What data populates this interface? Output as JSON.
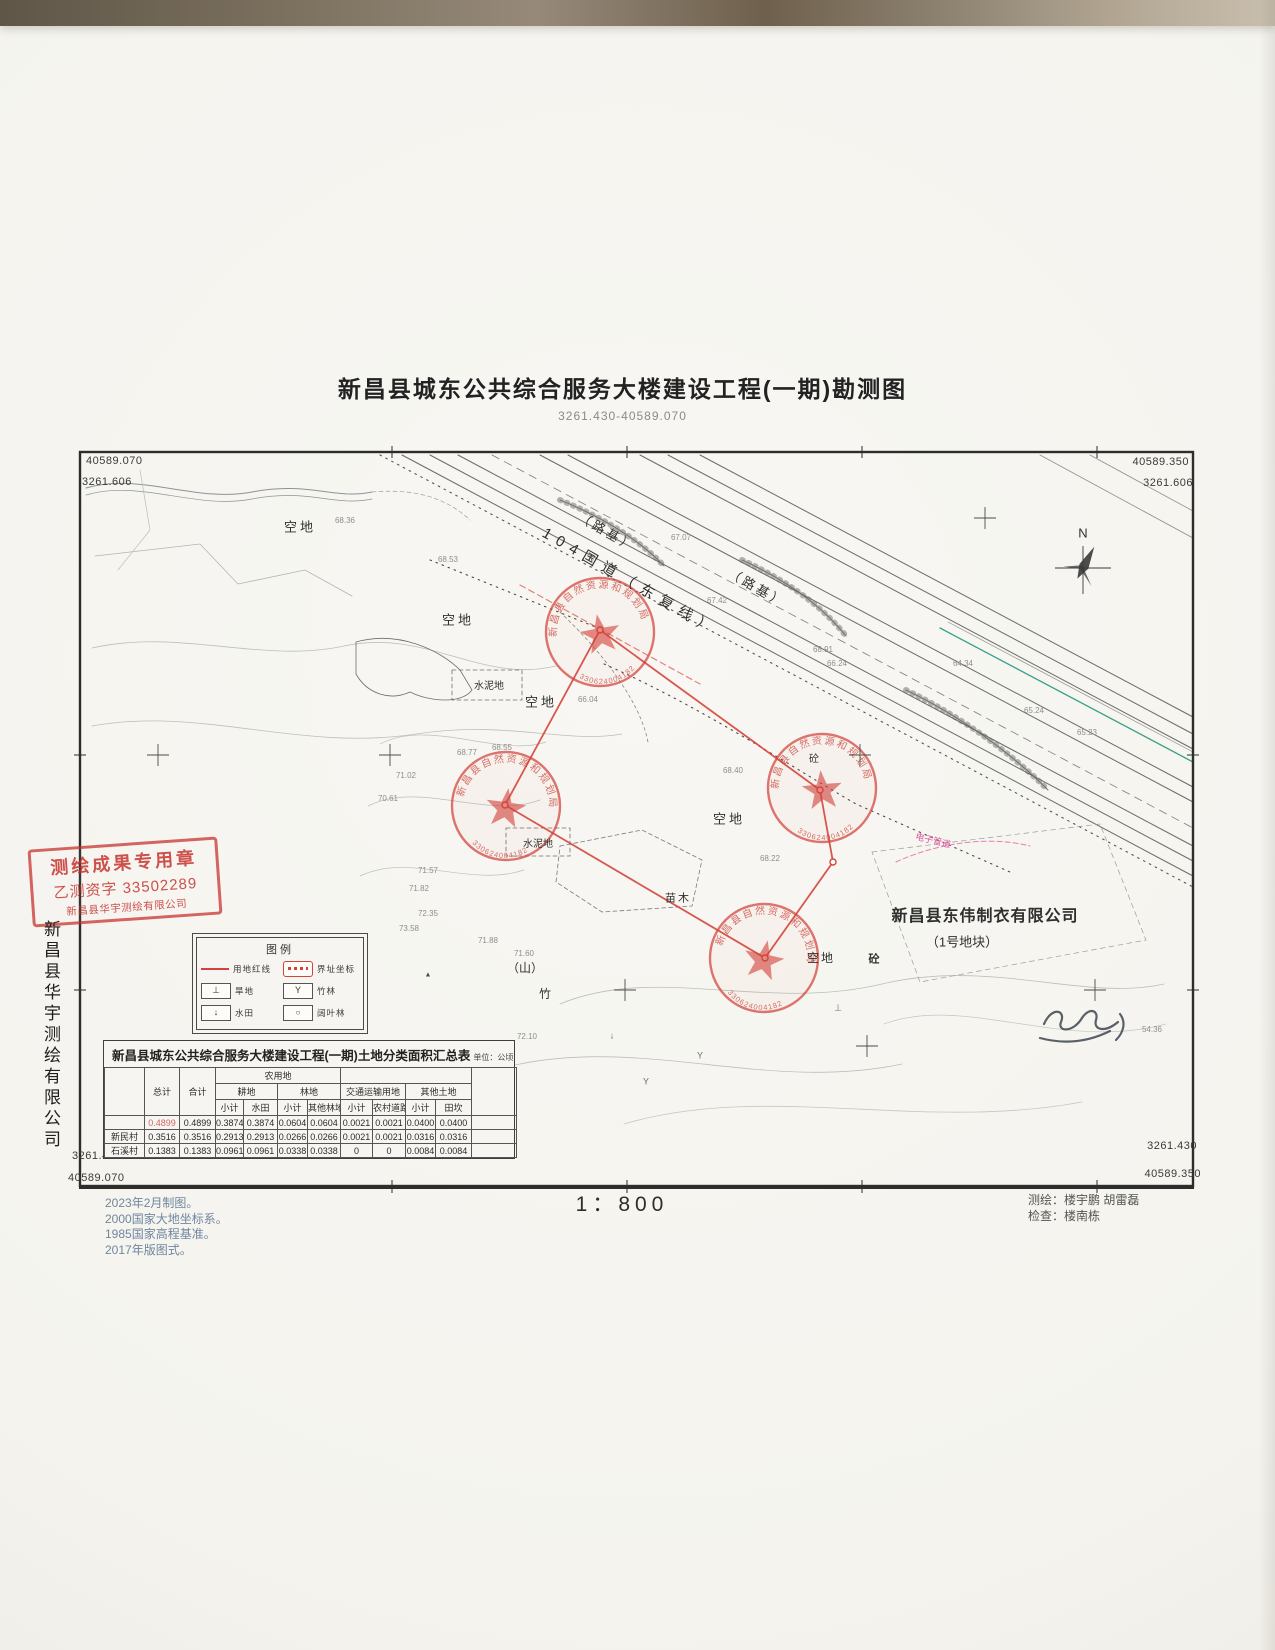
{
  "title": {
    "main": "新昌县城东公共综合服务大楼建设工程(一期)勘测图",
    "coords_range": "3261.430-40589.070"
  },
  "frame": {
    "top_left_x": "40589.070",
    "top_left_y": "3261.606",
    "top_right_x": "40589.350",
    "top_right_y": "3261.606",
    "bottom_left_y": "3261.430",
    "bottom_left_x": "40589.070",
    "bottom_right_y": "3261.430",
    "bottom_right_x": "40589.350"
  },
  "map": {
    "labels": [
      {
        "text": "104国道（东复线）",
        "x": 630,
        "y": 582,
        "size": 15,
        "rot": 30,
        "spacing": 7
      },
      {
        "text": "（路基）",
        "x": 607,
        "y": 532,
        "size": 13,
        "rot": 30,
        "spacing": 3
      },
      {
        "text": "（路基）",
        "x": 757,
        "y": 588,
        "size": 13,
        "rot": 30,
        "spacing": 3
      },
      {
        "text": "空地",
        "x": 300,
        "y": 527,
        "size": 13,
        "spacing": 3
      },
      {
        "text": "空地",
        "x": 458,
        "y": 620,
        "size": 13,
        "spacing": 3
      },
      {
        "text": "空地",
        "x": 541,
        "y": 702,
        "size": 13,
        "spacing": 3
      },
      {
        "text": "空地",
        "x": 729,
        "y": 819,
        "size": 13,
        "spacing": 3
      },
      {
        "text": "空地",
        "x": 821,
        "y": 958,
        "size": 12,
        "spacing": 2
      },
      {
        "text": "水泥地",
        "x": 489,
        "y": 687,
        "size": 10
      },
      {
        "text": "水泥地",
        "x": 538,
        "y": 845,
        "size": 10
      },
      {
        "text": "苗木",
        "x": 678,
        "y": 899,
        "size": 11,
        "spacing": 2
      },
      {
        "text": "（山）",
        "x": 525,
        "y": 968,
        "size": 12
      },
      {
        "text": "竹",
        "x": 545,
        "y": 994,
        "size": 12
      },
      {
        "text": "新昌县东伟制衣有限公司",
        "x": 985,
        "y": 917,
        "size": 16,
        "bold": true,
        "spacing": 1
      },
      {
        "text": "（1号地块）",
        "x": 962,
        "y": 942,
        "size": 13
      },
      {
        "text": "电子管道",
        "x": 933,
        "y": 841,
        "size": 9,
        "color": "#e0559e",
        "rot": 14
      },
      {
        "text": "N",
        "x": 1083,
        "y": 533,
        "size": 13
      },
      {
        "text": "砼",
        "x": 874,
        "y": 960,
        "size": 11,
        "bold": true
      },
      {
        "text": "砼",
        "x": 814,
        "y": 760,
        "size": 10
      },
      {
        "text": "Y",
        "x": 700,
        "y": 1056,
        "size": 9,
        "color": "#6b6b68"
      },
      {
        "text": "Y",
        "x": 646,
        "y": 1082,
        "size": 9,
        "color": "#6b6b68"
      },
      {
        "text": "↓",
        "x": 612,
        "y": 1036,
        "size": 9,
        "color": "#6b6b68"
      },
      {
        "text": "⊥",
        "x": 838,
        "y": 1008,
        "size": 9,
        "color": "#6b6b68"
      },
      {
        "text": "▲",
        "x": 428,
        "y": 975,
        "size": 7,
        "color": "#4a4a48"
      }
    ],
    "elevations": [
      {
        "v": "68.36",
        "x": 345,
        "y": 521
      },
      {
        "v": "68.53",
        "x": 448,
        "y": 560
      },
      {
        "v": "67.07",
        "x": 681,
        "y": 538
      },
      {
        "v": "67.42",
        "x": 717,
        "y": 601
      },
      {
        "v": "68.91",
        "x": 823,
        "y": 650
      },
      {
        "v": "66.24",
        "x": 837,
        "y": 664
      },
      {
        "v": "64.34",
        "x": 963,
        "y": 664
      },
      {
        "v": "65.24",
        "x": 1034,
        "y": 711
      },
      {
        "v": "65.23",
        "x": 1087,
        "y": 733
      },
      {
        "v": "68.77",
        "x": 467,
        "y": 753
      },
      {
        "v": "68.55",
        "x": 502,
        "y": 748
      },
      {
        "v": "66.04",
        "x": 588,
        "y": 700
      },
      {
        "v": "68.40",
        "x": 733,
        "y": 771
      },
      {
        "v": "68.22",
        "x": 770,
        "y": 859
      },
      {
        "v": "70.61",
        "x": 388,
        "y": 799
      },
      {
        "v": "71.02",
        "x": 406,
        "y": 776
      },
      {
        "v": "71.57",
        "x": 428,
        "y": 871
      },
      {
        "v": "71.82",
        "x": 419,
        "y": 889
      },
      {
        "v": "72.35",
        "x": 428,
        "y": 914
      },
      {
        "v": "73.58",
        "x": 409,
        "y": 929
      },
      {
        "v": "71.88",
        "x": 488,
        "y": 941
      },
      {
        "v": "71.60",
        "x": 524,
        "y": 954
      },
      {
        "v": "72.10",
        "x": 527,
        "y": 1037
      },
      {
        "v": "54.36",
        "x": 1152,
        "y": 1030
      }
    ],
    "round_stamps": {
      "arc_text": "新昌县自然资源和规划局",
      "number": "330624004182",
      "positions": [
        {
          "x": 600,
          "y": 632,
          "rot": -10
        },
        {
          "x": 506,
          "y": 806,
          "rot": 8
        },
        {
          "x": 822,
          "y": 788,
          "rot": -5
        },
        {
          "x": 764,
          "y": 958,
          "rot": 12
        }
      ]
    }
  },
  "legend": {
    "title": "图例",
    "left": [
      {
        "sym": "redline",
        "label": "用地红线"
      },
      {
        "sym": "dryland",
        "label": "旱地"
      },
      {
        "sym": "paddy",
        "label": "水田"
      }
    ],
    "right": [
      {
        "sym": "jzb",
        "label": "界址坐标"
      },
      {
        "sym": "bamboo",
        "label": "竹林"
      },
      {
        "sym": "broadleaf",
        "label": "阔叶林"
      }
    ]
  },
  "table": {
    "title": "新昌县城东公共综合服务大楼建设工程(一期)土地分类面积汇总表",
    "unit": "单位：公顷",
    "headers": {
      "total": "总计",
      "sum": "合计",
      "agri": "农用地",
      "cultivated": "耕地",
      "forest": "林地",
      "transport": "交通运输用地",
      "other_land": "其他土地",
      "subtotal": "小计",
      "paddy": "水田",
      "other_forest": "其他林地",
      "rural_road": "农村道路",
      "ridge": "田坎"
    },
    "rows": [
      {
        "name": "",
        "values": [
          "0.4899",
          "0.4899",
          "0.3874",
          "0.3874",
          "0.0604",
          "0.0604",
          "0.0021",
          "0.0021",
          "0.0400",
          "0.0400"
        ]
      },
      {
        "name": "新民村",
        "values": [
          "0.3516",
          "0.3516",
          "0.2913",
          "0.2913",
          "0.0266",
          "0.0266",
          "0.0021",
          "0.0021",
          "0.0316",
          "0.0316"
        ]
      },
      {
        "name": "石溪村",
        "values": [
          "0.1383",
          "0.1383",
          "0.0961",
          "0.0961",
          "0.0338",
          "0.0338",
          "0",
          "0",
          "0.0084",
          "0.0084"
        ]
      }
    ]
  },
  "side_stamp": {
    "line1": "测绘成果专用章",
    "line2": "乙测资字 33502289",
    "line3": "新昌县华宇测绘有限公司"
  },
  "margin_company": "新昌县华宇测绘有限公司",
  "scale": "1：800",
  "footer": {
    "notes": [
      "2023年2月制图。",
      "2000国家大地坐标系。",
      "1985国家高程基准。",
      "2017年版图式。"
    ],
    "surveyed": "测绘：楼宇鹏  胡雷磊",
    "checked": "检查：楼南栋"
  }
}
